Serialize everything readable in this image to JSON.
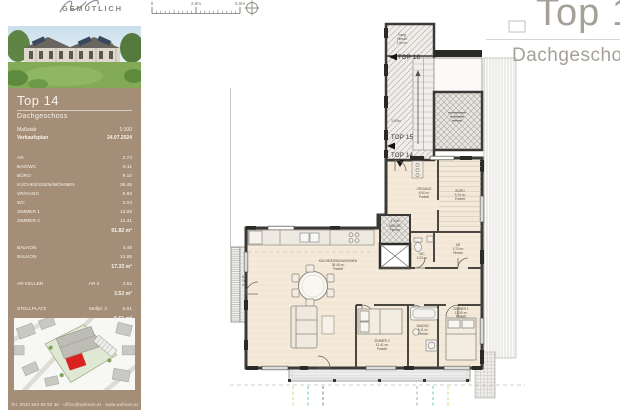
{
  "brand": {
    "name": "GEMÜTLICH"
  },
  "sidebar": {
    "unit_title": "Top 14",
    "unit_subtitle": "Dachgeschoss",
    "meta": [
      {
        "label": "Maßstab",
        "value": "1:100"
      },
      {
        "label": "Verkaufsplan",
        "value": "24.07.2024"
      }
    ],
    "rooms": [
      {
        "label": "AR",
        "value": "2.73"
      },
      {
        "label": "BAD/WC",
        "value": "5.11"
      },
      {
        "label": "BÜRO",
        "value": "9.10"
      },
      {
        "label": "KÜCHE/ESSEN/WOHNEN",
        "value": "38.45"
      },
      {
        "label": "VR/GANG",
        "value": "8.90"
      },
      {
        "label": "WC",
        "value": "2.03"
      },
      {
        "label": "ZIMMER 1",
        "value": "13.09"
      },
      {
        "label": "ZIMMER 2",
        "value": "12.41"
      }
    ],
    "rooms_total": "91.82 m²",
    "outdoor": [
      {
        "label": "BALKON",
        "value": "4.48"
      },
      {
        "label": "BALKON",
        "value": "12.85"
      }
    ],
    "outdoor_total": "17.33 m²",
    "extras": [
      {
        "label": "AR KELLER",
        "unit": "AR 2",
        "value": "3.52",
        "total": "3.52 m²"
      },
      {
        "label": "STELLPLATZ",
        "unit": "Stellpl. 2",
        "value": "5.61",
        "total": "5.61 m²"
      }
    ],
    "footer": "Tel. 0043 664 88 50 36 · office@wohnen.at · www.wohnen.at"
  },
  "header": {
    "title": "Top 14",
    "subtitle": "Dachgeschoss"
  },
  "scalebar": {
    "t0": "0",
    "t1": "2,5m",
    "t2": "5,0m"
  },
  "plan": {
    "tops": {
      "top16": "TOP 16",
      "top15": "TOP 15",
      "top14": "TOP 14"
    },
    "dims": {
      "stair": "3.80m",
      "bath": "1.00m"
    },
    "labels": {
      "gang_top": {
        "l1": "Gang",
        "l2": "Fliesen",
        "l3": "1.50 m²"
      },
      "kueche": {
        "l1": "KÜCHE/ESSEN/WOHNEN",
        "l2": "38.45 m²",
        "l3": "Parkett"
      },
      "zimmer1": {
        "l1": "ZIMMER 1",
        "l2": "13.09 m²",
        "l3": "Parkett"
      },
      "zimmer2": {
        "l1": "ZIMMER 2",
        "l2": "12.41 m²",
        "l3": "Parkett"
      },
      "bad": {
        "l1": "BAD/WC",
        "l2": "5.11 m²",
        "l3": "Fliesen"
      },
      "wc": {
        "l1": "WC",
        "l2": "2.03 m²"
      },
      "buero": {
        "l1": "BÜRO",
        "l2": "9.10 m²",
        "l3": "Parkett"
      },
      "vr": {
        "l1": "VR/GANG",
        "l2": "8.90 m²",
        "l3": "Parkett"
      },
      "ar": {
        "l1": "AR",
        "l2": "2.73 m²",
        "l3": "Fliesen"
      },
      "core_bad": {
        "l1": "BAD/WC",
        "l2": "Fliesen"
      },
      "balkon_left": {
        "l1": "Balkon",
        "l2": "Terrassenplatten",
        "l3": "4.48 m²"
      },
      "balkon_bottom": {
        "l1": "Balkon",
        "l2": "Terrassenplatten",
        "l3": "12.85 m²"
      }
    }
  },
  "colors": {
    "sidebar_brown": "#a58e77",
    "highlight_red": "#d8231f",
    "dash_yellow": "#e3dc9c",
    "dash_teal": "#8ed5c9",
    "dash_olive": "#9aa390",
    "dash_gray": "#bcbfba"
  }
}
